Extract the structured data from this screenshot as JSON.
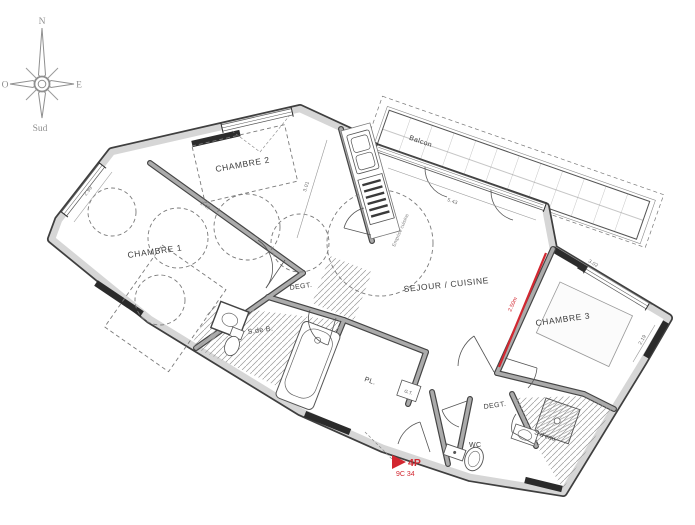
{
  "meta": {
    "background": "#ffffff",
    "wall_fill": "#d6d6d6",
    "wall_edge": "#3f3f3f",
    "line_color": "#555555",
    "hatch_color": "#9a9a9a",
    "accent_red": "#d22730",
    "text_color": "#3d3d3d",
    "compass_color": "#8f8f8f"
  },
  "compass": {
    "north": "N",
    "west": "O",
    "east": "E",
    "south": "Sud"
  },
  "rooms": {
    "chambre1": "CHAMBRE 1",
    "chambre2": "CHAMBRE 2",
    "chambre3": "CHAMBRE 3",
    "sejour": "SEJOUR / CUISINE",
    "balcon": "Balcon",
    "degagement1": "DEGT.",
    "degagement2": "DEGT.",
    "salle_de_bain": "S.de B.",
    "wc": "WC",
    "salle_eau": "S.d'eau",
    "placard": "PL.",
    "gaine_technique": "G.T.",
    "emprise": "Emprise cuisine"
  },
  "dimensions": {
    "kitchen": "3.01",
    "sejour_bay": "5.43",
    "chambre3_width": "3.02",
    "chambre3_depth": "2.19",
    "chambre1_window": "2.99",
    "chambre2_wall": "2.49"
  },
  "annotations": {
    "section_height": "2.50m",
    "unit_type": "4P",
    "unit_ref": "9C 34"
  }
}
